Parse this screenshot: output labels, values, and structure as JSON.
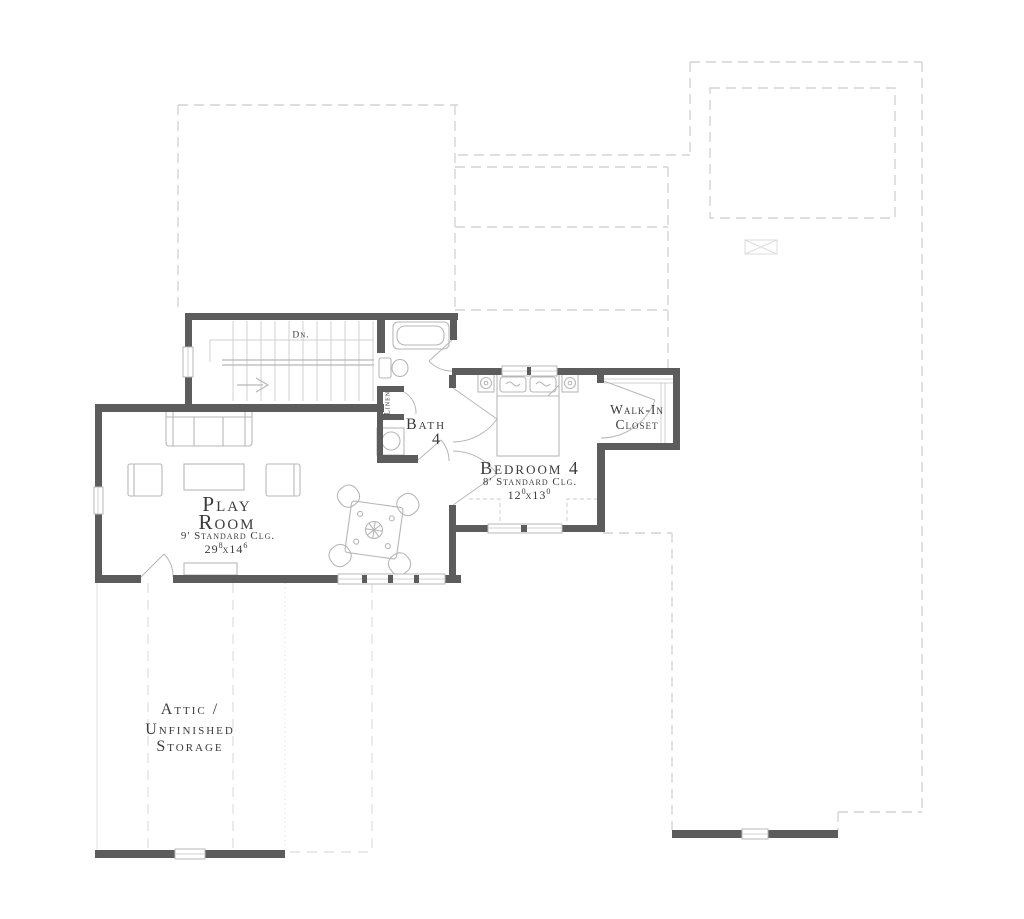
{
  "colors": {
    "wall": "#5c5c5c",
    "fixture": "#b7b7b7",
    "tread": "#d0d0d0",
    "dash": "#d4d4d4",
    "text": "#3b3b3b"
  },
  "labels": {
    "stairs_dn": "Dn.",
    "linen": "Linen",
    "bath": {
      "line1": "Bath",
      "line2": "4"
    },
    "bedroom": {
      "name": "Bedroom 4",
      "ceiling": "8' Standard Clg.",
      "dim": {
        "a": "12",
        "a_sup": "0",
        "sep": "x",
        "b": "13",
        "b_sup": "0"
      }
    },
    "closet": {
      "line1": "Walk-In",
      "line2": "Closet"
    },
    "playroom": {
      "line1": "Play",
      "line2": "Room",
      "ceiling": "9' Standard Clg.",
      "dim": {
        "a": "29",
        "a_sup": "8",
        "sep": "x",
        "b": "14",
        "b_sup": "6"
      }
    },
    "attic": {
      "line1": "Attic /",
      "line2": "Unfinished",
      "line3": "Storage"
    }
  }
}
